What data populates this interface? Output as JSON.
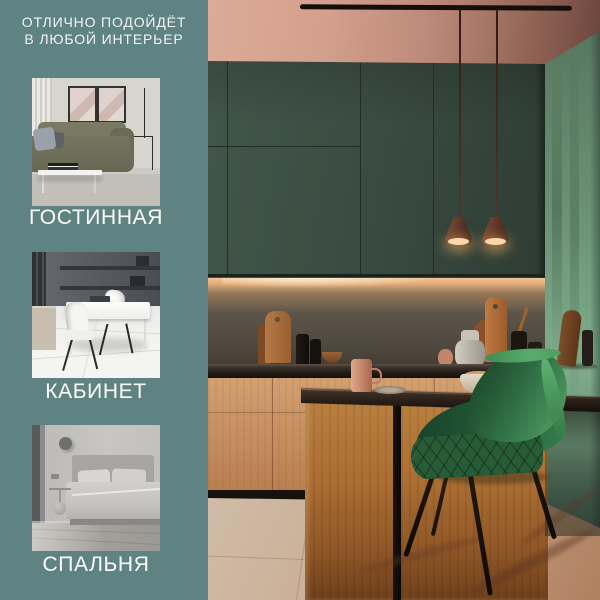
{
  "sidebar": {
    "headline": {
      "line1": "ОТЛИЧНО ПОДОЙДЁТ",
      "line2": "В ЛЮБОЙ ИНТЕРЬЕР"
    },
    "rooms": [
      {
        "id": "living-room",
        "label": "ГОСТИННАЯ"
      },
      {
        "id": "office",
        "label": "КАБИНЕТ"
      },
      {
        "id": "bedroom",
        "label": "СПАЛЬНЯ"
      }
    ]
  },
  "colors": {
    "sidebar_bg": "#5F8283",
    "headline_text": "#F2F5F0",
    "label_text": "#FBFCF8",
    "cabinet_green": "#3E5146",
    "wall_sage": "#6F9478",
    "chair_green": "#3C7C4E",
    "wood_cabinet": "#C68F63",
    "ceiling_pink": "#C99482",
    "countertop_dark": "#2B2420",
    "floor_beige": "#C3A68C"
  }
}
